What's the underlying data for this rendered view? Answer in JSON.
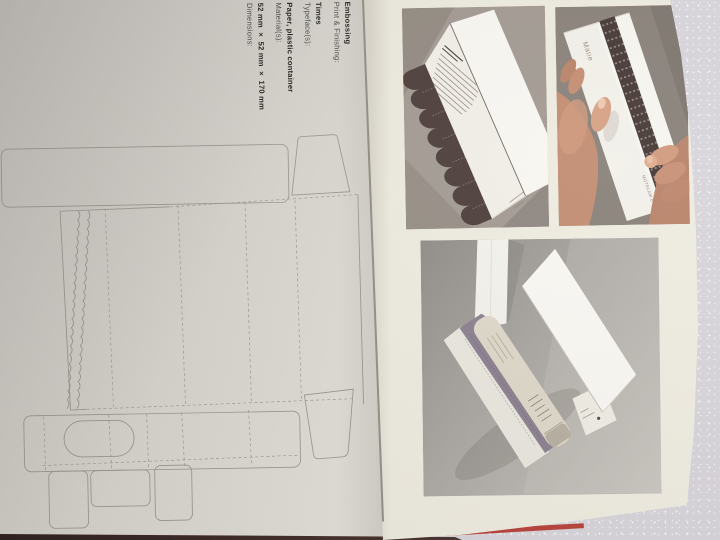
{
  "book": {
    "left_page": {
      "specs": [
        {
          "label": "Dimensions:",
          "value": "52 mm × 52 mm × 170 mm"
        },
        {
          "label": "Material(s):",
          "value": "Paper, plastic container"
        },
        {
          "label": "Typeface(s):",
          "value": "Times"
        },
        {
          "label": "Print & Finishing:",
          "value": "Embossing"
        }
      ]
    },
    "right_page": {
      "photo_top_right": {
        "brand_text": "Matie",
        "edge_text": "MOTELAM E"
      }
    },
    "colors": {
      "left_page_paper": "#d3d0ca",
      "right_page_paper": "#edeadf",
      "photo_background_taupe": "#a29a92",
      "lace_pattern_dark": "#4d3e3a",
      "lace_pattern_mauve": "#8c8090",
      "table_surface": "#d8d5db",
      "book_cover_edge": "#3a2a25",
      "cover_accent_red": "#b8433c"
    }
  }
}
